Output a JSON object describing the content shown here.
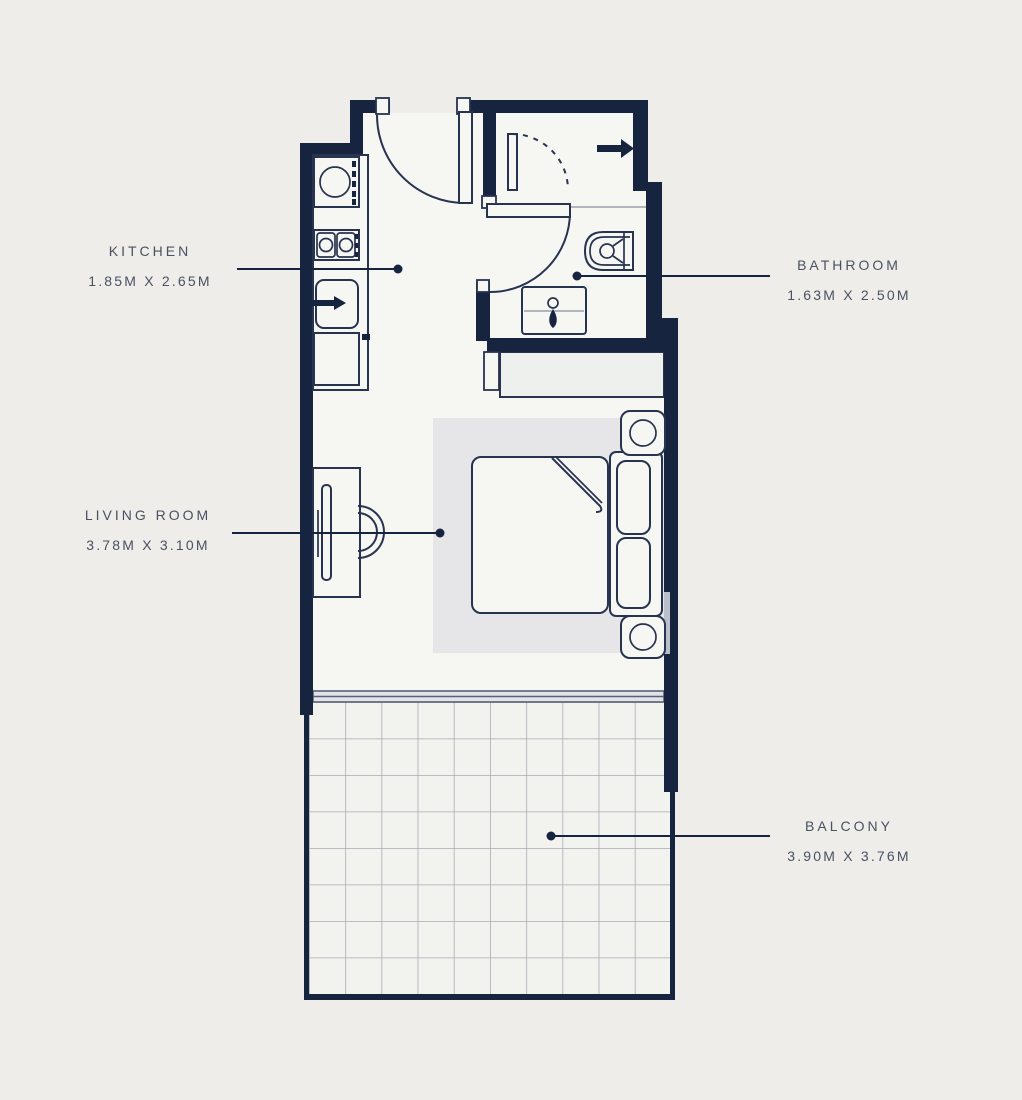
{
  "plan": {
    "type": "studio-apartment-floor-plan",
    "colors": {
      "bg": "#efede9",
      "wall": "#172440",
      "room": "#f6f6f3",
      "line": "#27334f",
      "tile": "#a6aab1",
      "balcony": "#f2f2ef",
      "rug": "#e6e6e8",
      "label": "#4a5162",
      "track": "#566079"
    }
  },
  "rooms": {
    "kitchen": {
      "name": "KITCHEN",
      "dimensions": "1.85M X 2.65M"
    },
    "bathroom": {
      "name": "BATHROOM",
      "dimensions": "1.63M X 2.50M"
    },
    "living_room": {
      "name": "LIVING ROOM",
      "dimensions": "3.78M X 3.10M"
    },
    "balcony": {
      "name": "BALCONY",
      "dimensions": "3.90M X 3.76M"
    }
  },
  "fixtures": [
    "entry-door",
    "kitchen-sink",
    "stove",
    "refrigerator",
    "kitchen-cabinet",
    "shower-door",
    "shower-arrow",
    "bathroom-door",
    "toilet",
    "bathroom-sink",
    "wardrobe",
    "tv-unit",
    "desk-chair",
    "double-bed",
    "pillows",
    "nightstand-lamp-top",
    "nightstand-lamp-bottom",
    "sliding-window",
    "balcony-tiles"
  ]
}
